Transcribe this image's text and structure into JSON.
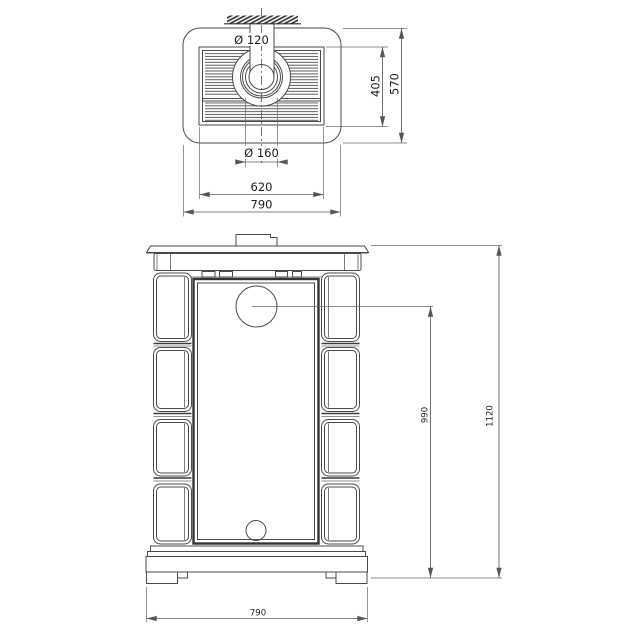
{
  "top_view": {
    "pipe_diameter": "Ø 120",
    "collar_diameter": "Ø 160",
    "grille_width": "620",
    "width": "790",
    "grille_depth": "405",
    "depth": "570"
  },
  "front_view": {
    "flue_center_height": "990",
    "total_height": "1120",
    "width": "790"
  },
  "colors": {
    "line": "#4a4a4a",
    "dark_line": "#333333",
    "dimension": "#5a5a5a",
    "background": "#ffffff"
  }
}
